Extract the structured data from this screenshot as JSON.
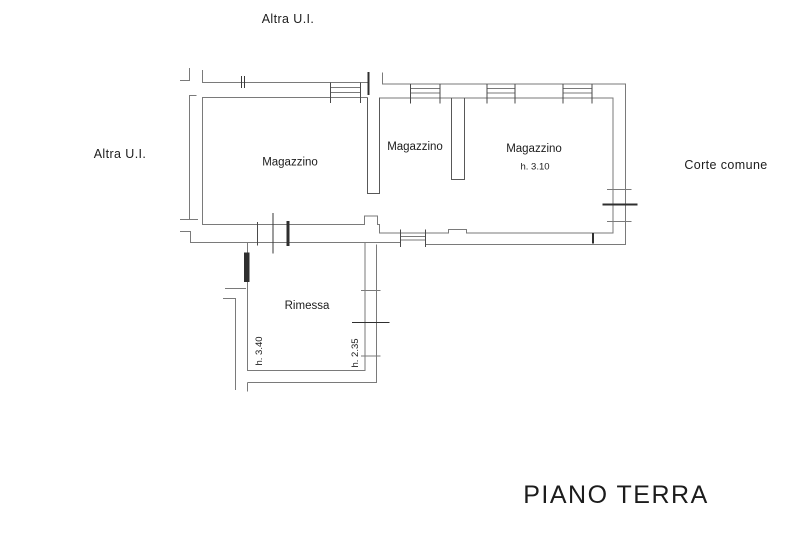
{
  "floor_plan": {
    "title": "PIANO  TERRA",
    "exterior_labels": {
      "top": "Altra U.I.",
      "left": "Altra U.I.",
      "right": "Corte comune"
    },
    "rooms": {
      "magazzino_1": {
        "label": "Magazzino"
      },
      "magazzino_2": {
        "label": "Magazzino"
      },
      "magazzino_3": {
        "label": "Magazzino",
        "height": "h. 3.10"
      },
      "rimessa": {
        "label": "Rimessa",
        "height_left": "h. 3.40",
        "height_right": "h. 2.35"
      }
    },
    "colors": {
      "background": "#ffffff",
      "wall": "#7a7a7a",
      "wall_dark": "#2f2f2f",
      "text": "#1c1c1c"
    }
  }
}
